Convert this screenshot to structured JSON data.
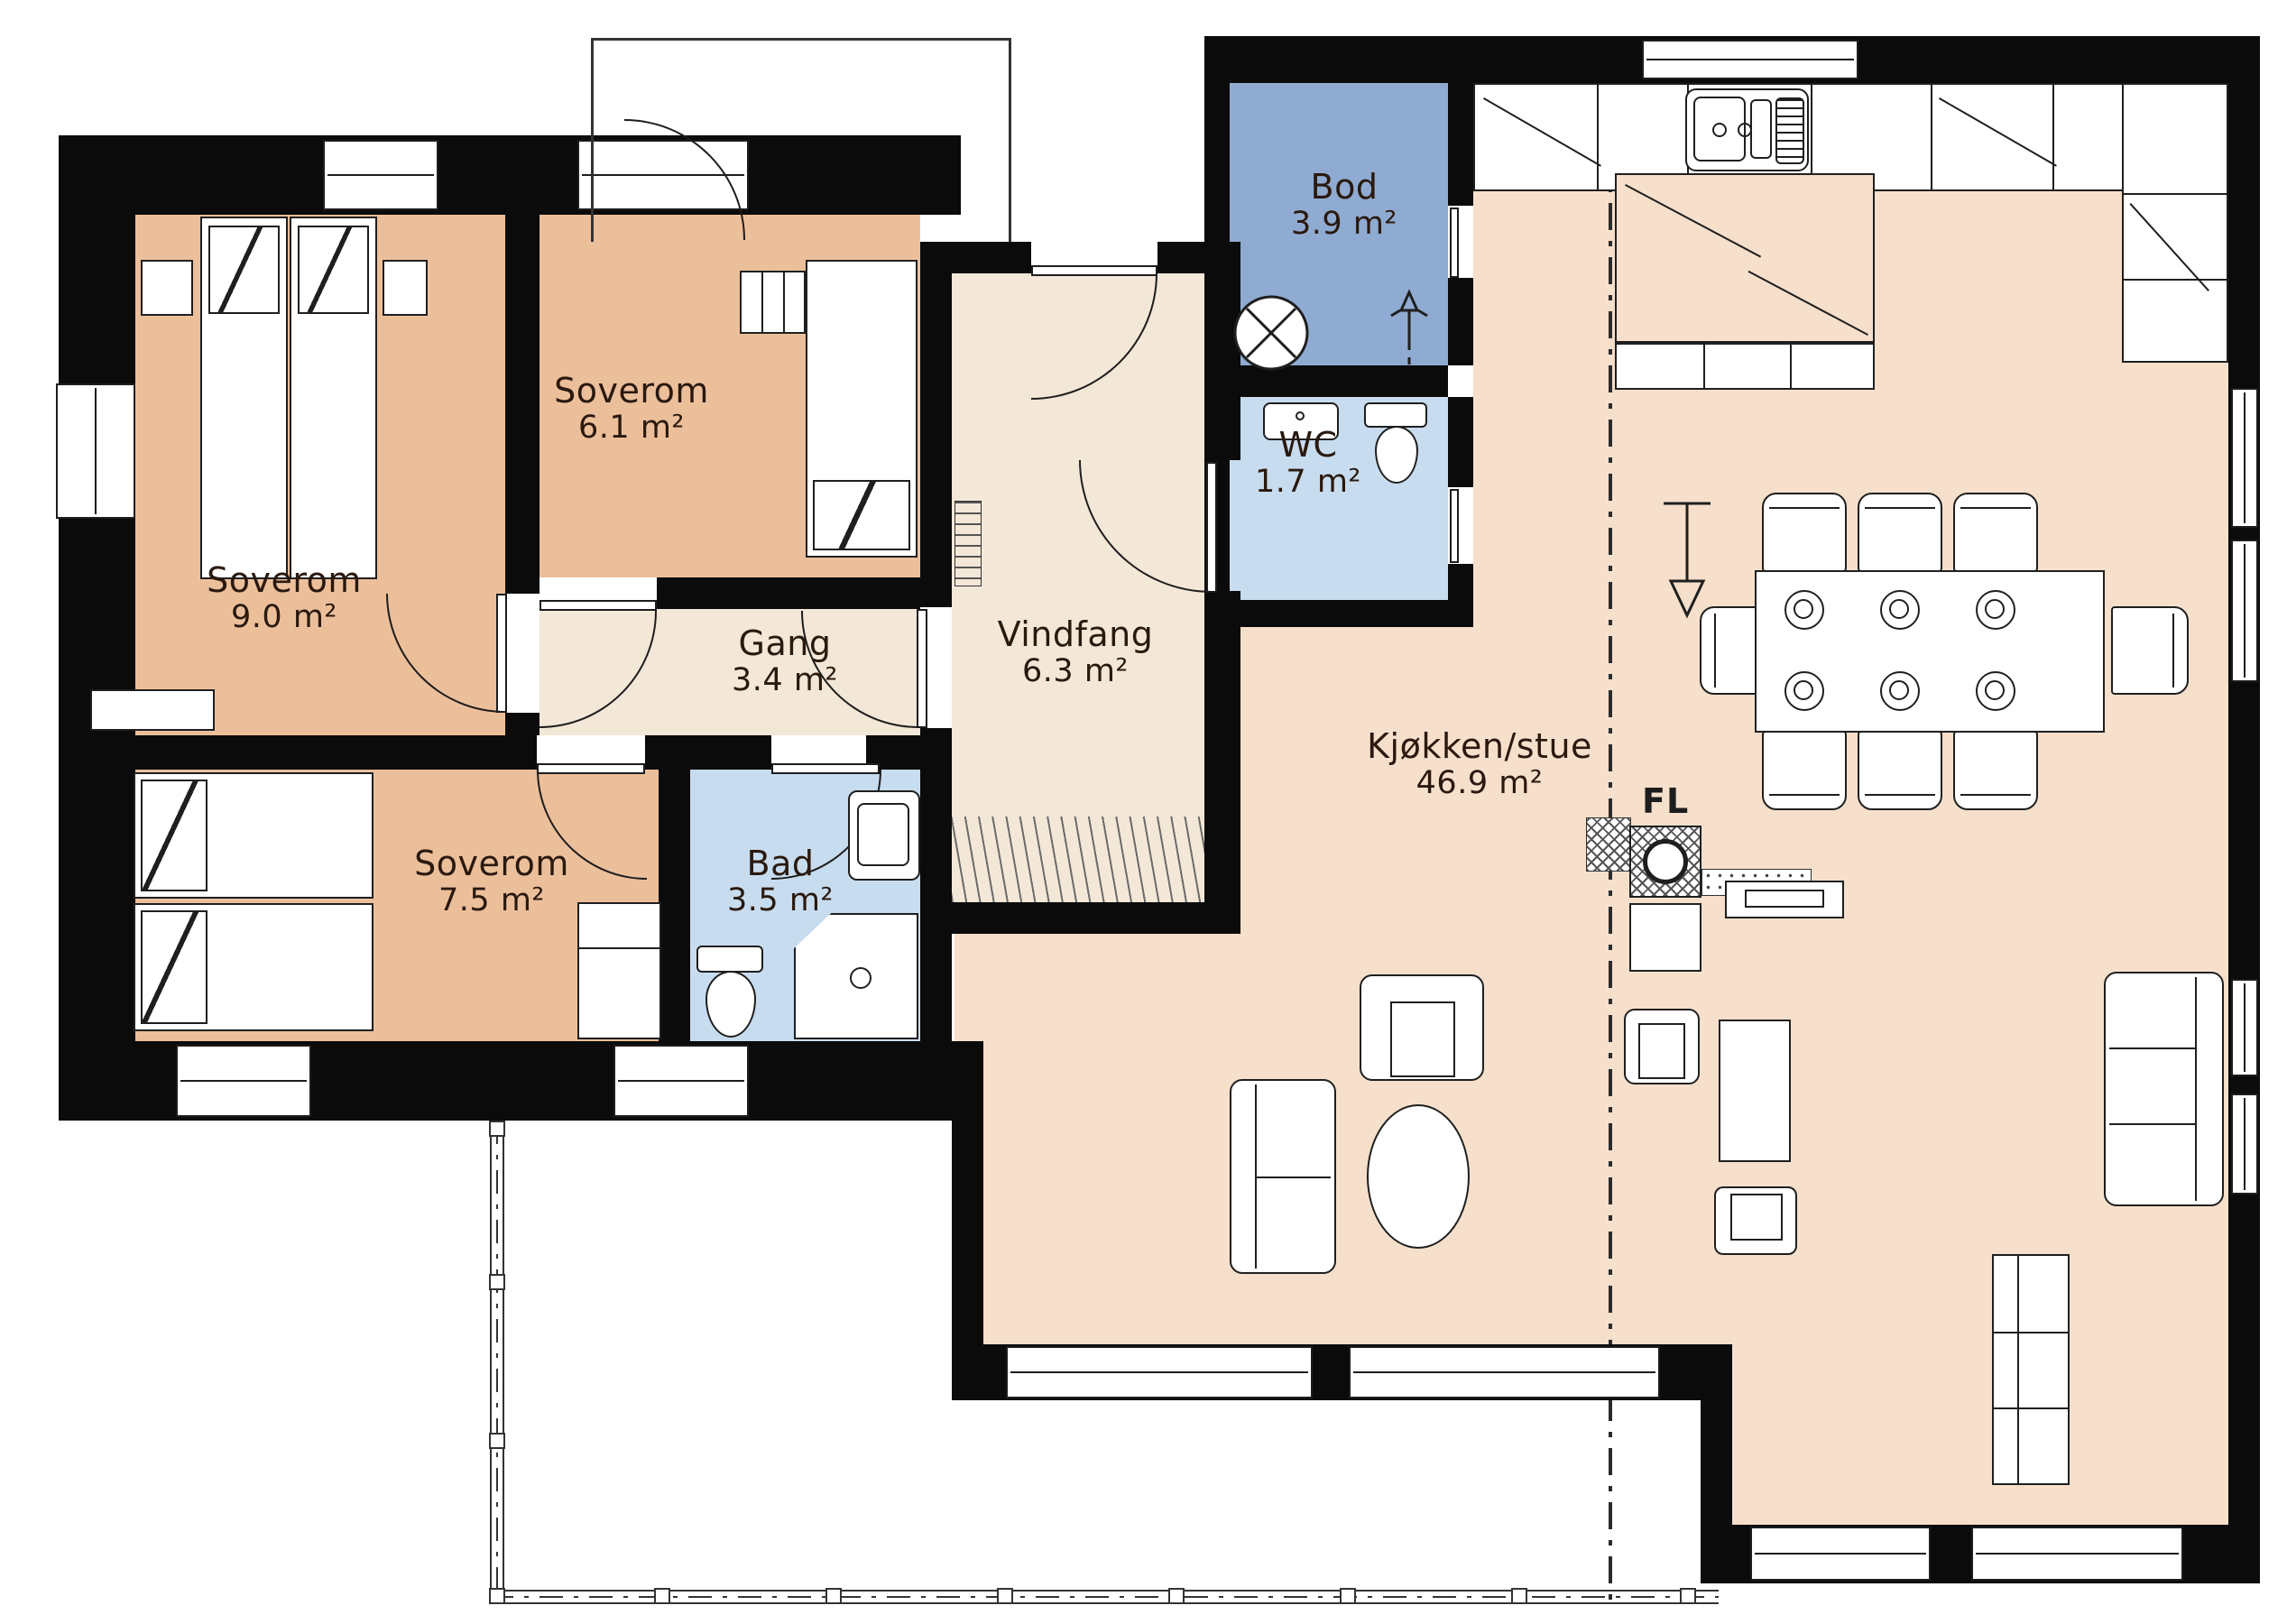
{
  "colors": {
    "wall": "#0b0b0b",
    "bedroom_fill": "#ecbf9b",
    "hall_fill": "#f3e7d8",
    "kitchen_living_fill": "#f6dfcb",
    "storage_fill": "#8fabd1",
    "wet_room_fill": "#c8dcef",
    "line": "#1f1f1f",
    "label_text": "#2a190e"
  },
  "rooms": [
    {
      "id": "soverom-9",
      "name": "Soverom",
      "area": "9.0 m²"
    },
    {
      "id": "soverom-6",
      "name": "Soverom",
      "area": "6.1 m²"
    },
    {
      "id": "gang",
      "name": "Gang",
      "area": "3.4 m²"
    },
    {
      "id": "soverom-7",
      "name": "Soverom",
      "area": "7.5 m²"
    },
    {
      "id": "bad",
      "name": "Bad",
      "area": "3.5 m²"
    },
    {
      "id": "vindfang",
      "name": "Vindfang",
      "area": "6.3 m²"
    },
    {
      "id": "bod",
      "name": "Bod",
      "area": "3.9 m²"
    },
    {
      "id": "wc",
      "name": "WC",
      "area": "1.7 m²"
    },
    {
      "id": "kjokken-stue",
      "name": "Kjøkken/stue",
      "area": "46.9 m²"
    }
  ],
  "annotations": {
    "fireplace_label": "FL"
  }
}
